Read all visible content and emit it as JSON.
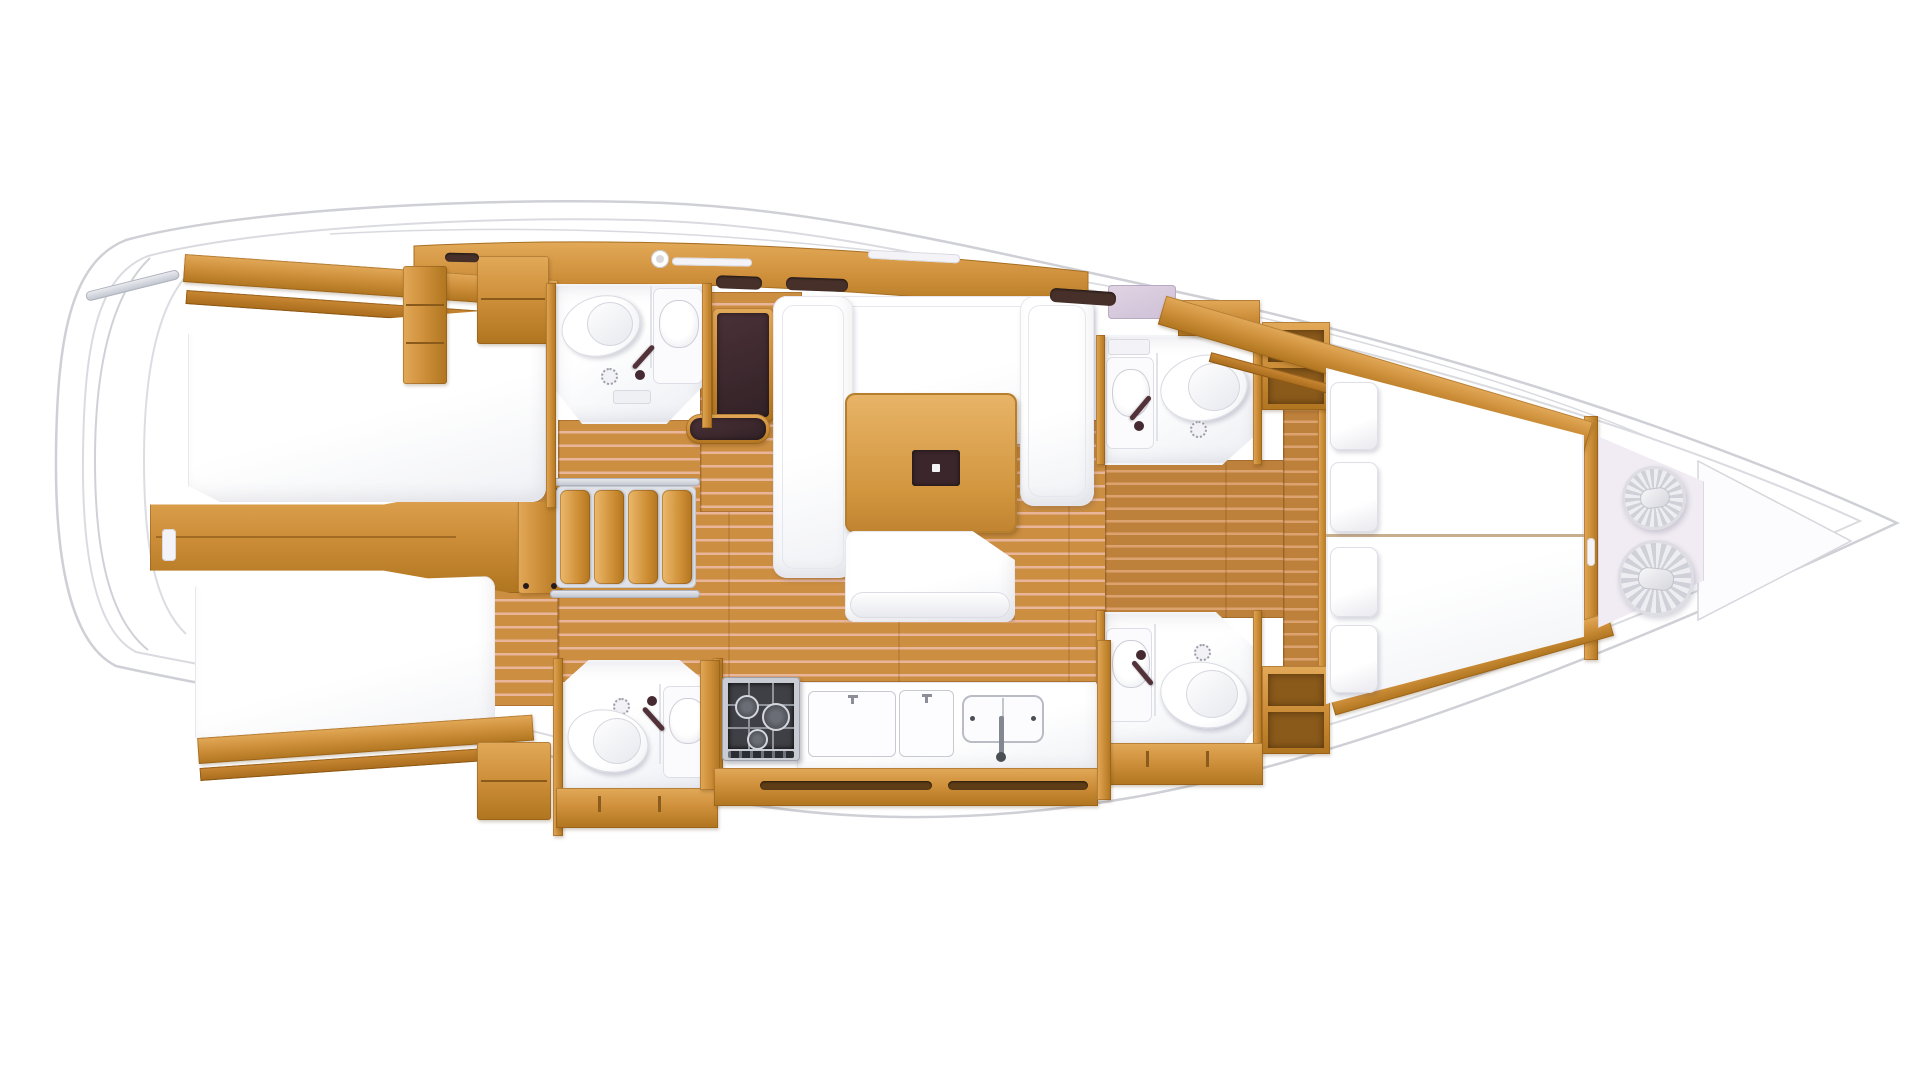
{
  "diagram": {
    "type": "yacht-interior-floor-plan",
    "label": "Sailing yacht interior layout plan, top view, bow to the right",
    "background": "#ffffff"
  },
  "palette": {
    "hull_line": "#CFD0D6",
    "deck_line": "#DADBE0",
    "wood_light": "#E2A958",
    "wood": "#CE8F3A",
    "wood_dark": "#B0751F",
    "teak_floor": "#CC8E41",
    "teak_seam": "#E9B59B",
    "fixture_white": "#FFFFFF",
    "fixture_shade": "#E3E4EA",
    "dark_upholstery": "#3D292E",
    "metal": "#C7CAD2",
    "lavender_shelf": "#D9CBDD"
  },
  "layout": {
    "stern": {
      "features": [
        "swim-platform-arcs",
        "transom-bar"
      ]
    },
    "aft_cabin_top": {
      "type": "double-berth-cabin",
      "berths": 1,
      "features": [
        "berth",
        "hull-shelf",
        "wardrobe",
        "locker"
      ]
    },
    "aft_cabin_bottom": {
      "type": "double-berth-cabin",
      "berths": 1,
      "features": [
        "berth",
        "hull-shelf",
        "nightstand",
        "entry-floor"
      ]
    },
    "corridor": {
      "features": [
        "engine-compartment",
        "door",
        "center-seam"
      ]
    },
    "companionway": {
      "steps": 4
    },
    "head_aft_top": {
      "fixtures": [
        "toilet",
        "washbasin",
        "shower-drain",
        "faucet"
      ]
    },
    "head_aft_bottom": {
      "fixtures": [
        "toilet",
        "washbasin",
        "shower-drain",
        "faucet"
      ]
    },
    "nav_station": {
      "features": [
        "chart-seat",
        "bench"
      ]
    },
    "salon": {
      "features": [
        "u-settee",
        "dining-table",
        "table-inlay",
        "bench-sofa"
      ]
    },
    "galley": {
      "burners": 3,
      "features": [
        "gas-stove",
        "counter-lid",
        "counter-lid",
        "double-sink",
        "faucet",
        "locker-handles"
      ]
    },
    "head_fwd_top": {
      "fixtures": [
        "toilet",
        "washbasin",
        "shower-drain",
        "faucet",
        "shelf"
      ]
    },
    "head_fwd_bottom": {
      "fixtures": [
        "toilet",
        "washbasin",
        "shower-drain",
        "faucet"
      ]
    },
    "forward_cabin": {
      "berths": 2,
      "pillows": 4,
      "features": [
        "v-berth",
        "center-seam",
        "hull-shelves",
        "entry-bulkhead"
      ]
    },
    "sail_locker": {
      "rope_coils": 2
    },
    "anchor_locker": {
      "shape": "triangle"
    }
  }
}
